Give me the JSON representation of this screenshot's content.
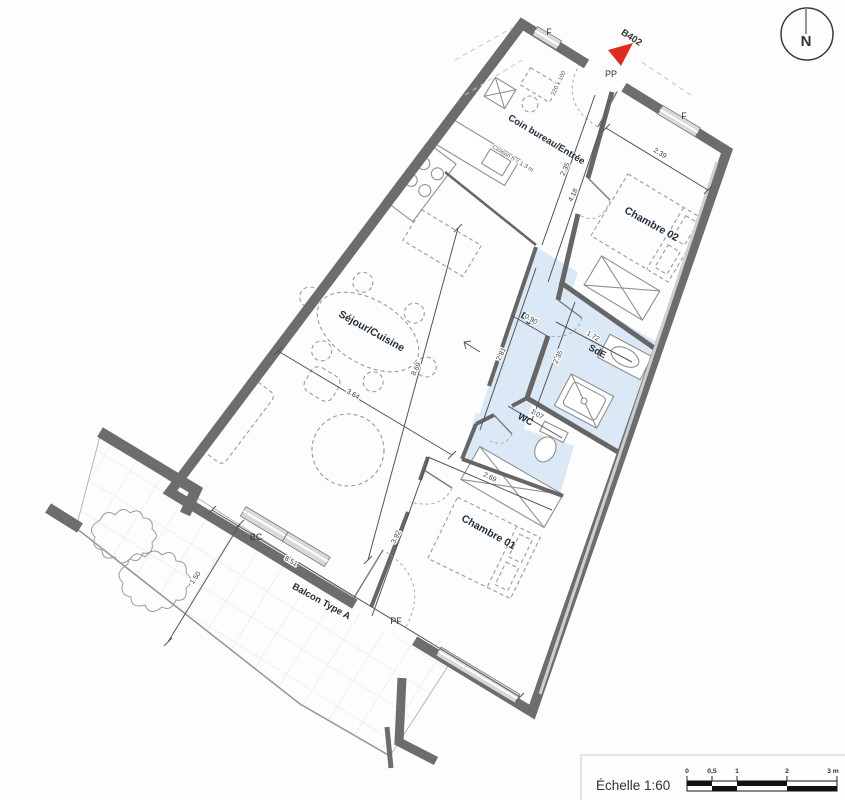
{
  "plan": {
    "unit": {
      "label": "B402"
    },
    "north_label": "N",
    "rooms": {
      "entry": "Coin bureau/Entrée",
      "bedroom2": "Chambre 02",
      "living": "Séjour/Cuisine",
      "hall": "Dgt",
      "shower": "SdE",
      "wc": "WC",
      "bedroom1": "Chambre 01",
      "balcony": "Balcon Type A"
    },
    "openings": {
      "window1": "F",
      "window2": "F",
      "entrance": "PP",
      "bay": "BC",
      "french_door": "PF"
    },
    "notes": {
      "partition": "Cloison h = 1.3 m",
      "door_size": "220 x 100"
    },
    "dims": {
      "entry_depth": "2.35",
      "bedroom2_w": "2.39",
      "bedroom2_l": "4.18",
      "hall_w": "0.90",
      "hall_l": "2.81",
      "shower_w": "1.72",
      "shower_l": "2.35",
      "wc_w": "1.07",
      "bedroom1_w": "2.69",
      "bedroom1_l": "3.92",
      "living_w": "3.64",
      "living_l": "8.69",
      "balcony_l": "8.51",
      "balcony_w": "1.50"
    },
    "colors": {
      "highlight": "#dbe8f6",
      "wall": "#6d6d6d",
      "red": "#e02b20"
    }
  },
  "scalebar": {
    "title": "Échelle 1:60",
    "ticks": [
      "0",
      "0,5",
      "1",
      "2",
      "3 m"
    ]
  }
}
